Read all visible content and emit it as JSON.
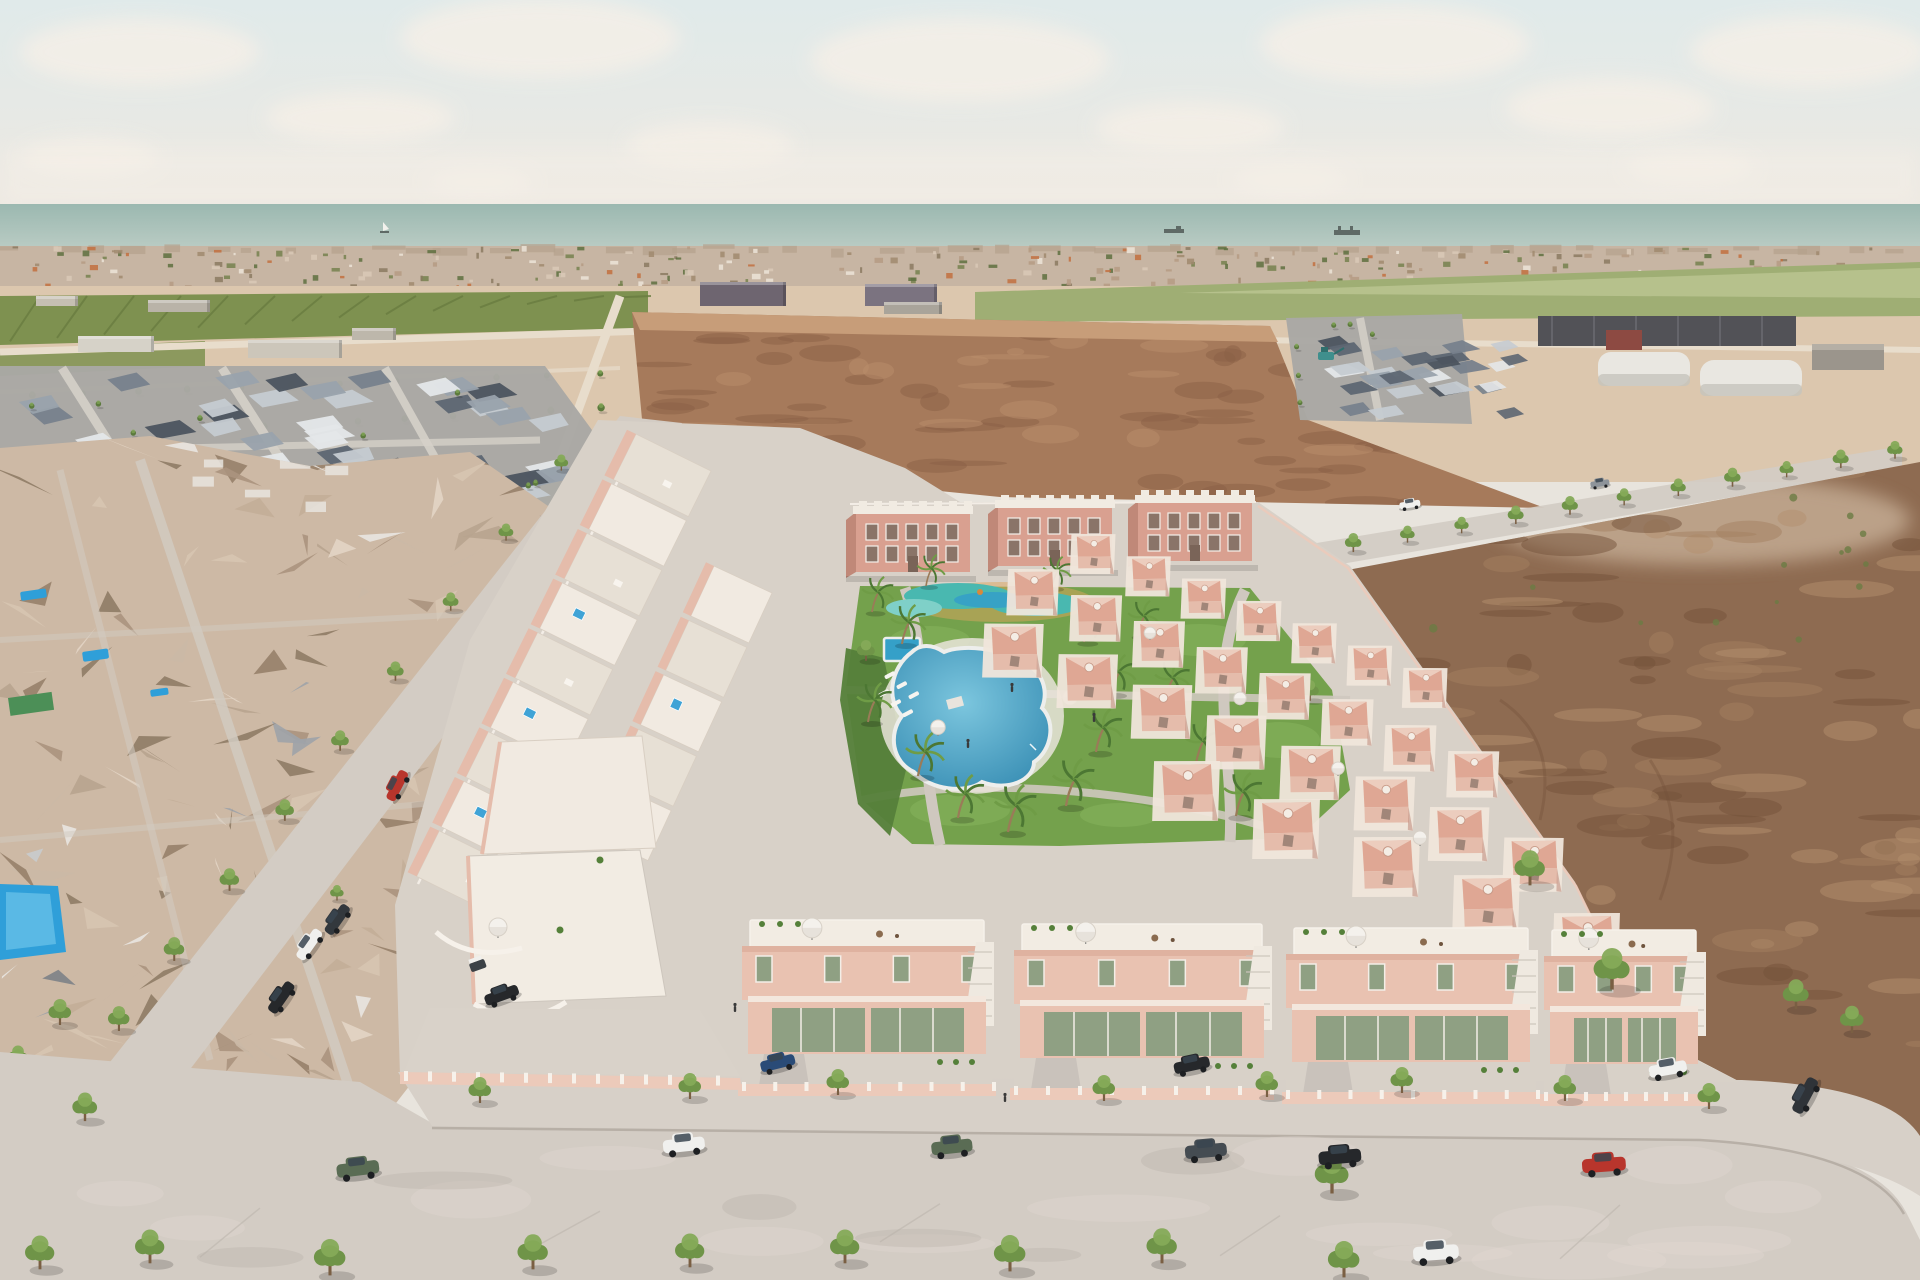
{
  "scene": {
    "type": "architectural-aerial-render",
    "title": "Aerial 3D render of a new pink townhouse development by the sea",
    "description": "CGI bird's-eye visualisation: rows of salmon-pink townhouses and three small apartment blocks around a communal garden with a lagoon pool, children's splash park and palm trees; an existing photogrammetry neighbourhood on the left, empty sandy plots and a brown field on the right, tree-lined streets with parked cars in front, and the sea with ships on the horizon.",
    "environment": {
      "sky": "hazy sky with soft clouds",
      "sea_visible": true,
      "ships": [
        "sailboat",
        "cargo ship",
        "cargo ship"
      ]
    },
    "development": {
      "apartment_blocks": 3,
      "townhouse_units_left_rows": 14,
      "villa_units_right_rows": 28,
      "front_villas": 5,
      "sun_loungers": 6,
      "palm_trees": 16,
      "amenities": [
        "lagoon swimming pool",
        "children's splash pool",
        "rectangular plunge pool",
        "sun loungers",
        "palm garden",
        "playground",
        "roof terraces",
        "rooftop jacuzzis",
        "parasols"
      ]
    },
    "vehicles": {
      "street_parked": [
        "white car",
        "silver car",
        "red car",
        "white pickup",
        "black SUV",
        "dark sedan"
      ],
      "front_road_parked": [
        "green SUV",
        "white SUV",
        "green SUV",
        "grey SUV",
        "black SUV",
        "red sedan"
      ],
      "moving": [
        "white coupe"
      ],
      "driveway": [
        "dark sedan",
        "blue car",
        "black sedan",
        "white car",
        "golf buggy"
      ],
      "distant": [
        "white car",
        "grey car",
        "teal excavator"
      ]
    },
    "palette": {
      "sky_top": "#e0eaea",
      "sky_bottom": "#ede8e1",
      "cloud": "#f4efe7",
      "sea_top": "#9bb8b0",
      "sea_bottom": "#bccdc5",
      "horizon": "#9fb5ac",
      "ship": "#5f6a66",
      "sail": "#f2f1ec",
      "city_base": "#c7b5a3",
      "city_top": "#b5a18c",
      "specks": [
        "#ece4d8",
        "#d9c9b7",
        "#b59b84",
        "#a0896f",
        "#8b7a61",
        "#75814f",
        "#5e7040",
        "#c2703f"
      ],
      "orchard": "#7e9150",
      "orchard_dark": "#697c40",
      "field_green": "#9fae74",
      "field_green_light": "#bcc692",
      "sand": "#dcc7ae",
      "sand_light": "#e8d7c0",
      "road_light": "#e8ddcc",
      "plow": "#a67a5b",
      "plow_dark": "#8a5f45",
      "plow_mid": "#b98e6b",
      "plow_top": "#c79d79",
      "grey_base": "#a9a8a4",
      "roof_greys": [
        "#5d6672",
        "#77818c",
        "#99a2ac",
        "#c5cbd1",
        "#e4e7e9",
        "#4c545f"
      ],
      "district_street": "#d6d1c9",
      "industry_dark": "#525257",
      "industry_red": "#8d4a42",
      "hangar": "#e9e7e1",
      "hangar_shade": "#c6c4bd",
      "shed": "#9b958c",
      "excavator": "#3f8f8d",
      "dirt": "#8e6b51",
      "dirt_dark": "#73513a",
      "dirt_mid": "#a3805f",
      "dirt_light": "#b4906d",
      "scrub": "#6b7c44",
      "mesh_tans": [
        "#e3d5c5",
        "#d7c5b1",
        "#c3ae98",
        "#ab947e",
        "#97816a",
        "#b8a48f",
        "#cbb9a6",
        "#8f7c66"
      ],
      "mesh_greys": [
        "#9fa3a8",
        "#c9ccce",
        "#e9e6e1",
        "#7d8287"
      ],
      "pool_blue": "#2f9fd9",
      "pool_blue_light": "#6cc4ea",
      "street": "#d3ccc4",
      "curb": "#b0a89f",
      "dev_ground": "#d8d1c8",
      "dev_path": "#cfc8bf",
      "row_roof": "#f1eae1",
      "row_roof_alt": "#e7e0d5",
      "row_wall": "#e5bcab",
      "row_wall_dark": "#cf9a87",
      "divider": "#d8cec2",
      "jacuzzi": "#3fa3d6",
      "apt_wall": "#d9a090",
      "apt_side": "#c08878",
      "apt_roof": "#f1ebe2",
      "apt_win": "#8a7468",
      "apt_frame": "#f4efe9",
      "villa_wall": "#e9c2b1",
      "villa_wall_dark": "#d8a795",
      "glass": "#8fa083",
      "glass_frame": "#f3eee7",
      "roof_slab": "#f2ece3",
      "terrace": "#cdc6bd",
      "fence_pink": "#eccaba",
      "fence_white": "#f6f1ea",
      "lawn": "#74a14c",
      "lawn_light": "#86b55c",
      "hedge": "#55803a",
      "kids_teal": "#49b8b0",
      "kids_teal_light": "#7fd0c8",
      "kids_inner": "#35a0c8",
      "play_orange": "#d9883c",
      "play_deck": "#dca55e",
      "lagoon_deep": "#2f86ae",
      "lagoon_light": "#7cc6de",
      "lagoon_edge": "#edeeec",
      "palm_trunk": "#9a7b58",
      "frond": "#4c7733",
      "frond_light": "#6f9c46",
      "tree_dark": "#5c7a3d",
      "tree_mid": "#6f9448",
      "tree_light": "#85aa58",
      "trunk": "#7a5f43",
      "umbrella": "#f4f1ec",
      "umbrella_shade": "#d8d1c7",
      "car_white": "#f0f0ee",
      "car_black": "#26282b",
      "car_green": "#5a6c54",
      "car_grey": "#454c52",
      "car_silver": "#c9cdd1",
      "car_red": "#b8352c",
      "car_blue": "#2a4b77",
      "wheel": "#1d1f22",
      "person": "#3a3a3a"
    }
  }
}
